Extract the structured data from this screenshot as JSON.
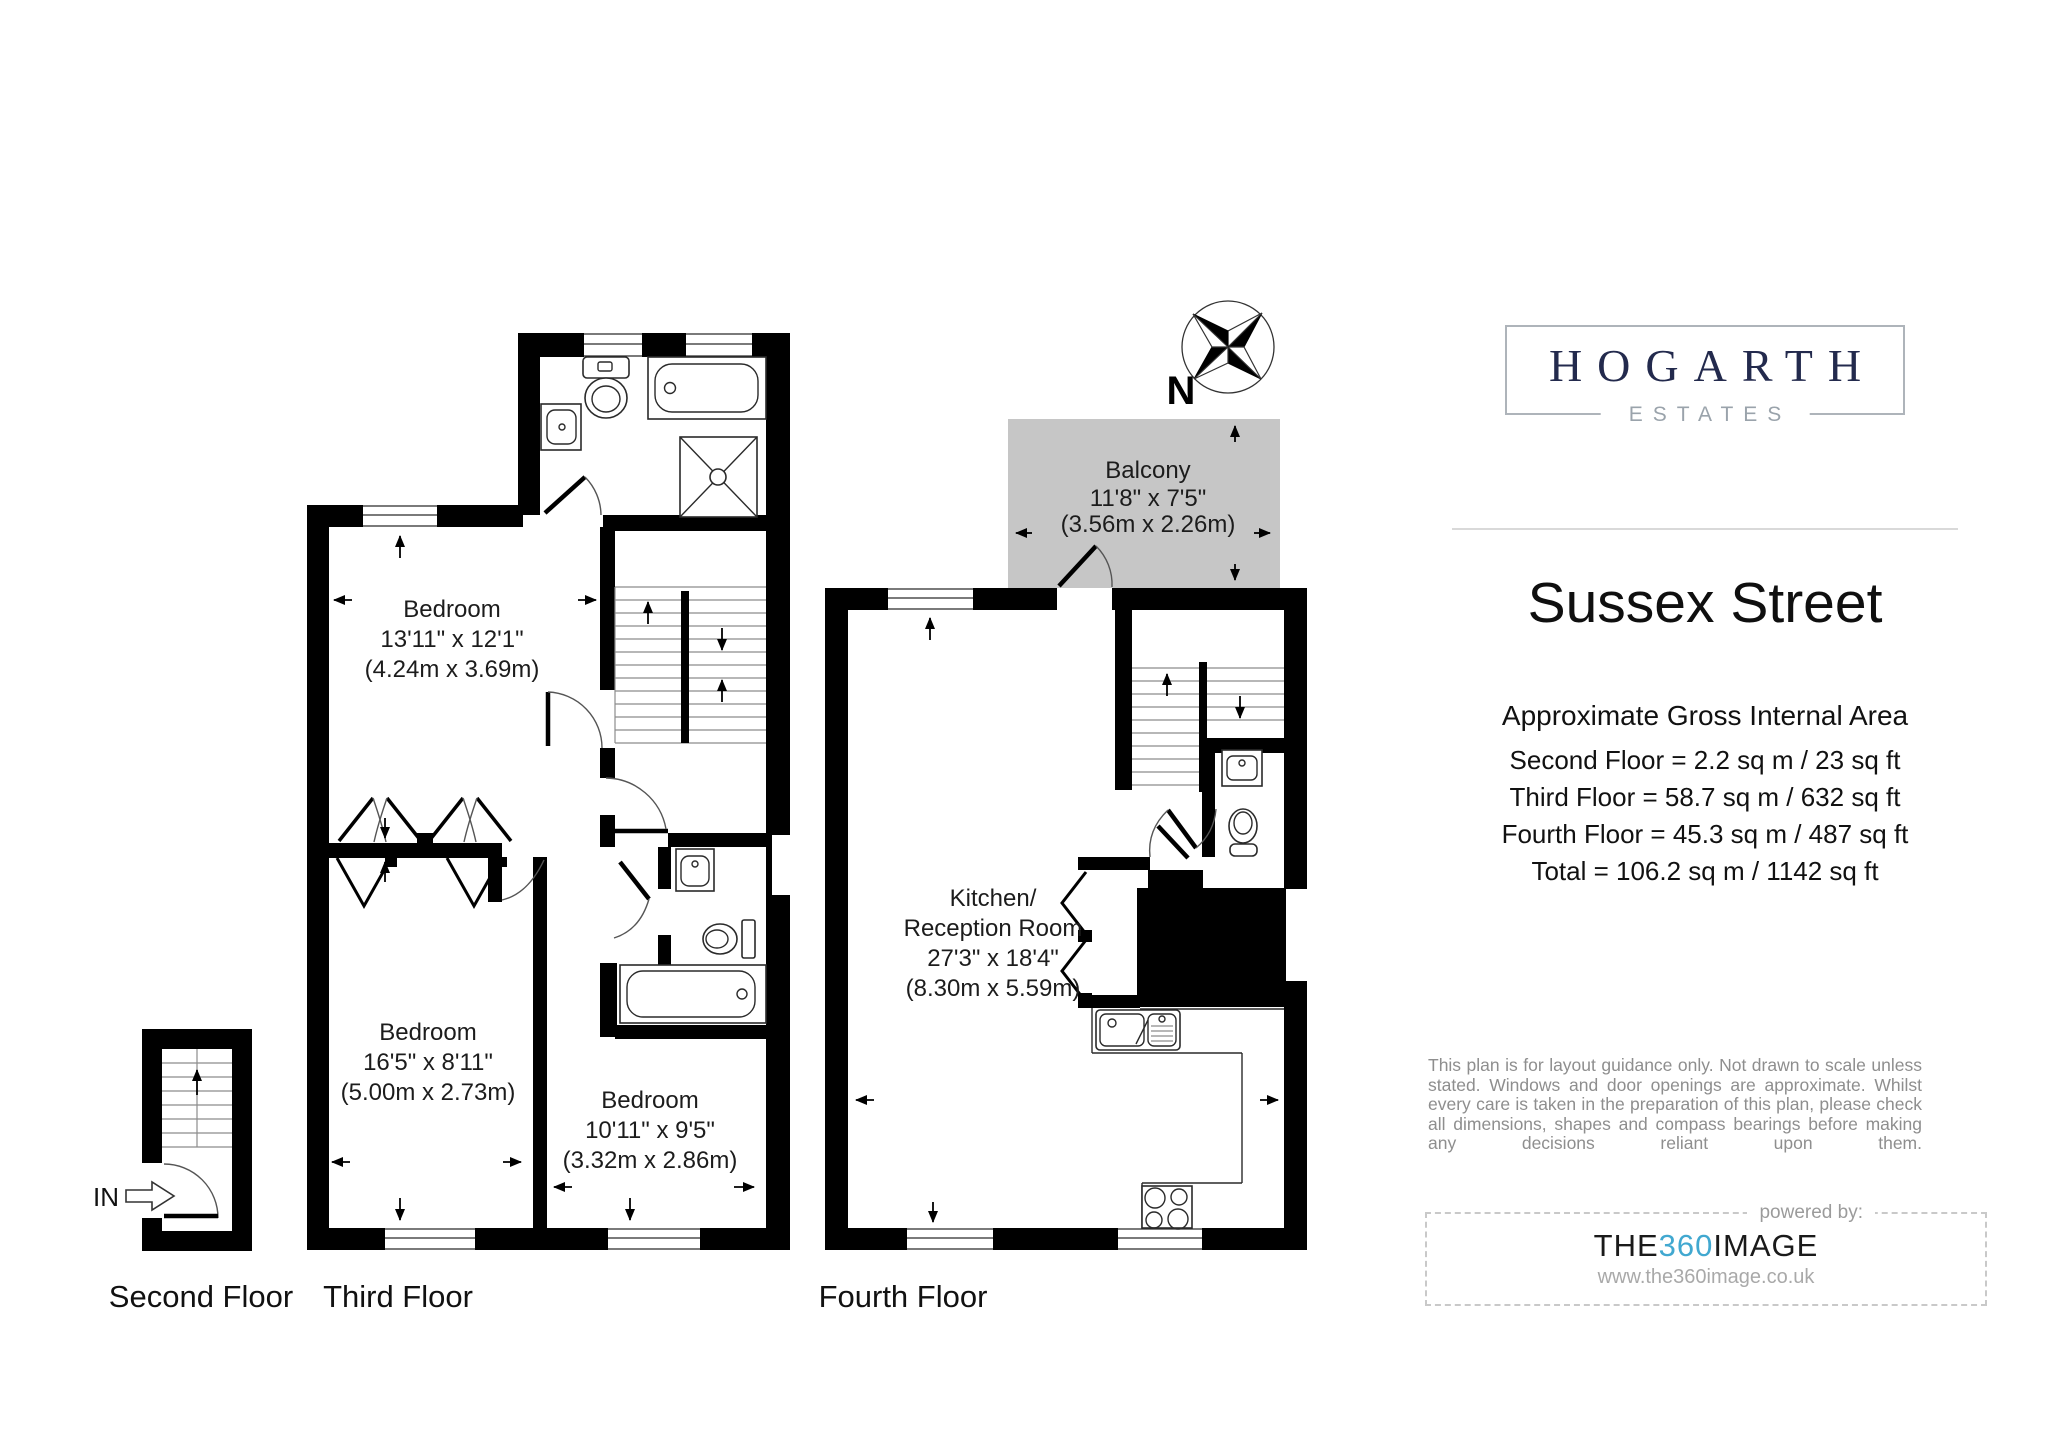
{
  "compass": {
    "north_label": "N"
  },
  "plans": {
    "second_floor": {
      "label": "Second Floor",
      "entry_label": "IN"
    },
    "third_floor": {
      "label": "Third Floor",
      "bedroom1": {
        "name": "Bedroom",
        "imperial": "13'11\" x 12'1\"",
        "metric": "(4.24m x 3.69m)"
      },
      "bedroom2": {
        "name": "Bedroom",
        "imperial": "16'5\" x 8'11\"",
        "metric": "(5.00m x 2.73m)"
      },
      "bedroom3": {
        "name": "Bedroom",
        "imperial": "10'11\" x 9'5\"",
        "metric": "(3.32m x 2.86m)"
      }
    },
    "fourth_floor": {
      "label": "Fourth Floor",
      "balcony": {
        "name": "Balcony",
        "imperial": "11'8\" x 7'5\"",
        "metric": "(3.56m x 2.26m)"
      },
      "kitchen": {
        "name_line1": "Kitchen/",
        "name_line2": "Reception Room",
        "imperial": "27'3\" x 18'4\"",
        "metric": "(8.30m x 5.59m)"
      }
    }
  },
  "sidebar": {
    "logo": {
      "name": "HOGARTH",
      "subtitle": "ESTATES"
    },
    "title": "Sussex Street",
    "area": {
      "heading": "Approximate Gross Internal Area",
      "lines": [
        "Second Floor = 2.2 sq m / 23 sq ft",
        "Third Floor = 58.7 sq m / 632 sq ft",
        "Fourth Floor = 45.3 sq m / 487 sq ft",
        "Total = 106.2 sq m / 1142 sq ft"
      ]
    },
    "disclaimer": "This plan is for layout guidance only. Not drawn to scale unless stated. Windows and door openings are approximate. Whilst every care is taken in the preparation of this plan, please check all dimensions, shapes and compass bearings before making any decisions reliant upon them.",
    "powered": {
      "caption": "powered by:",
      "brand_pre": "THE",
      "brand_mid": "360",
      "brand_post": "IMAGE",
      "url": "www.the360image.co.uk"
    }
  },
  "colors": {
    "wall": "#000000",
    "balcony_fill": "#c6c6c6",
    "brand_navy": "#232a4d",
    "brand_gray": "#9aa3ab",
    "accent_blue": "#41a8d0",
    "note_gray": "#8e8e8e"
  }
}
